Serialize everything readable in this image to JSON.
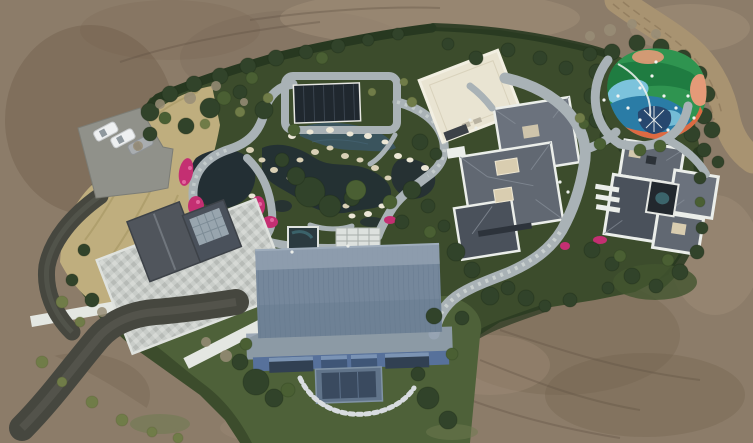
{
  "meta": {
    "title": "Aerial drone photograph of a landscaped private estate",
    "type": "aerial-photograph",
    "no_visible_text": true
  },
  "scene": {
    "subject": "Top-down drone view of an estate compound: ornamental pond garden with rockery and azaleas, garden pavilion, barn-style hall with blue standing-seam roof, stone-terrace house, two slate hip-roof villas, colorful children playground, winding stone footpaths, parking with three cars, asphalt driveway, lawns and dense shrubs, all ringed by bare graded earth and a dirt track",
    "elements": [
      "bare-earth-terrain",
      "dirt-track",
      "boundary-hedge",
      "dry-grass-bank",
      "parking-area",
      "parked-cars",
      "asphalt-driveway",
      "stone-terrace-house",
      "retaining-walls",
      "ornamental-pond",
      "rockery-stones",
      "azalea-beds",
      "garden-pavilion",
      "plunge-pool",
      "pergola-deck",
      "barn-building",
      "flat-roof-annex",
      "hip-roof-villa",
      "courtyard-villa",
      "playground",
      "stone-footpaths",
      "lawn",
      "trees-and-shrubs"
    ]
  },
  "colors": {
    "dirt_base": "#8c7c69",
    "dirt_light": "#a2907a",
    "dirt_dark": "#71604d",
    "dirt_speck": "#5e5042",
    "dirt_road": "#a89371",
    "dry_grass": "#bfae7e",
    "dry_grass_dark": "#a3945f",
    "lawn": "#4e6139",
    "lawn_dark": "#42552f",
    "shrub_base": "#3c4c2c",
    "hedge": "#273820",
    "tree_dark": "#31432a",
    "tree_mid": "#4a5f33",
    "tree_olive": "#707c48",
    "tree_bare": "#988d77",
    "asphalt": "#46473f",
    "asphalt_worn": "#5b5c53",
    "pavement": "#90918a",
    "stone_path": "#a9b2b6",
    "stone_light": "#cfd5d4",
    "white_trim": "#ebeeea",
    "terrace_edge": "#dfe2de",
    "roof_left": "#50555c",
    "roof_slate": "#616872",
    "roof_slate2": "#6b727d",
    "roof_dark": "#4a515b",
    "skylight": "#a6b4bd",
    "beige_skylight": "#d9cdb0",
    "cream_roof": "#e9e4d2",
    "barn_roof": "#75879b",
    "barn_roof_light": "#93a1b1",
    "barn_wall": "#57719b",
    "window_dark": "#314052",
    "window_light": "#8aa3c4",
    "bay_frame": "#61748a",
    "pavilion_roof": "#20282f",
    "water_dark": "#232f34",
    "water_blue": "#3a5666",
    "pool_teal": "#3e6a72",
    "rock": "#d9d0b5",
    "rock_white": "#ece7d6",
    "azalea": "#c42f72",
    "azalea_light": "#e2679f",
    "car_white": "#eef0f1",
    "car_silver": "#a9adb0",
    "car_glass": "#8f989e",
    "play_green": "#2f9450",
    "play_green_dark": "#1f7a40",
    "play_teal": "#2a7ca6",
    "play_blue": "#7cc3dc",
    "play_orange": "#dd6a42",
    "play_salmon": "#e49a78",
    "play_navy": "#27476e",
    "play_white": "#f2f4f1"
  }
}
